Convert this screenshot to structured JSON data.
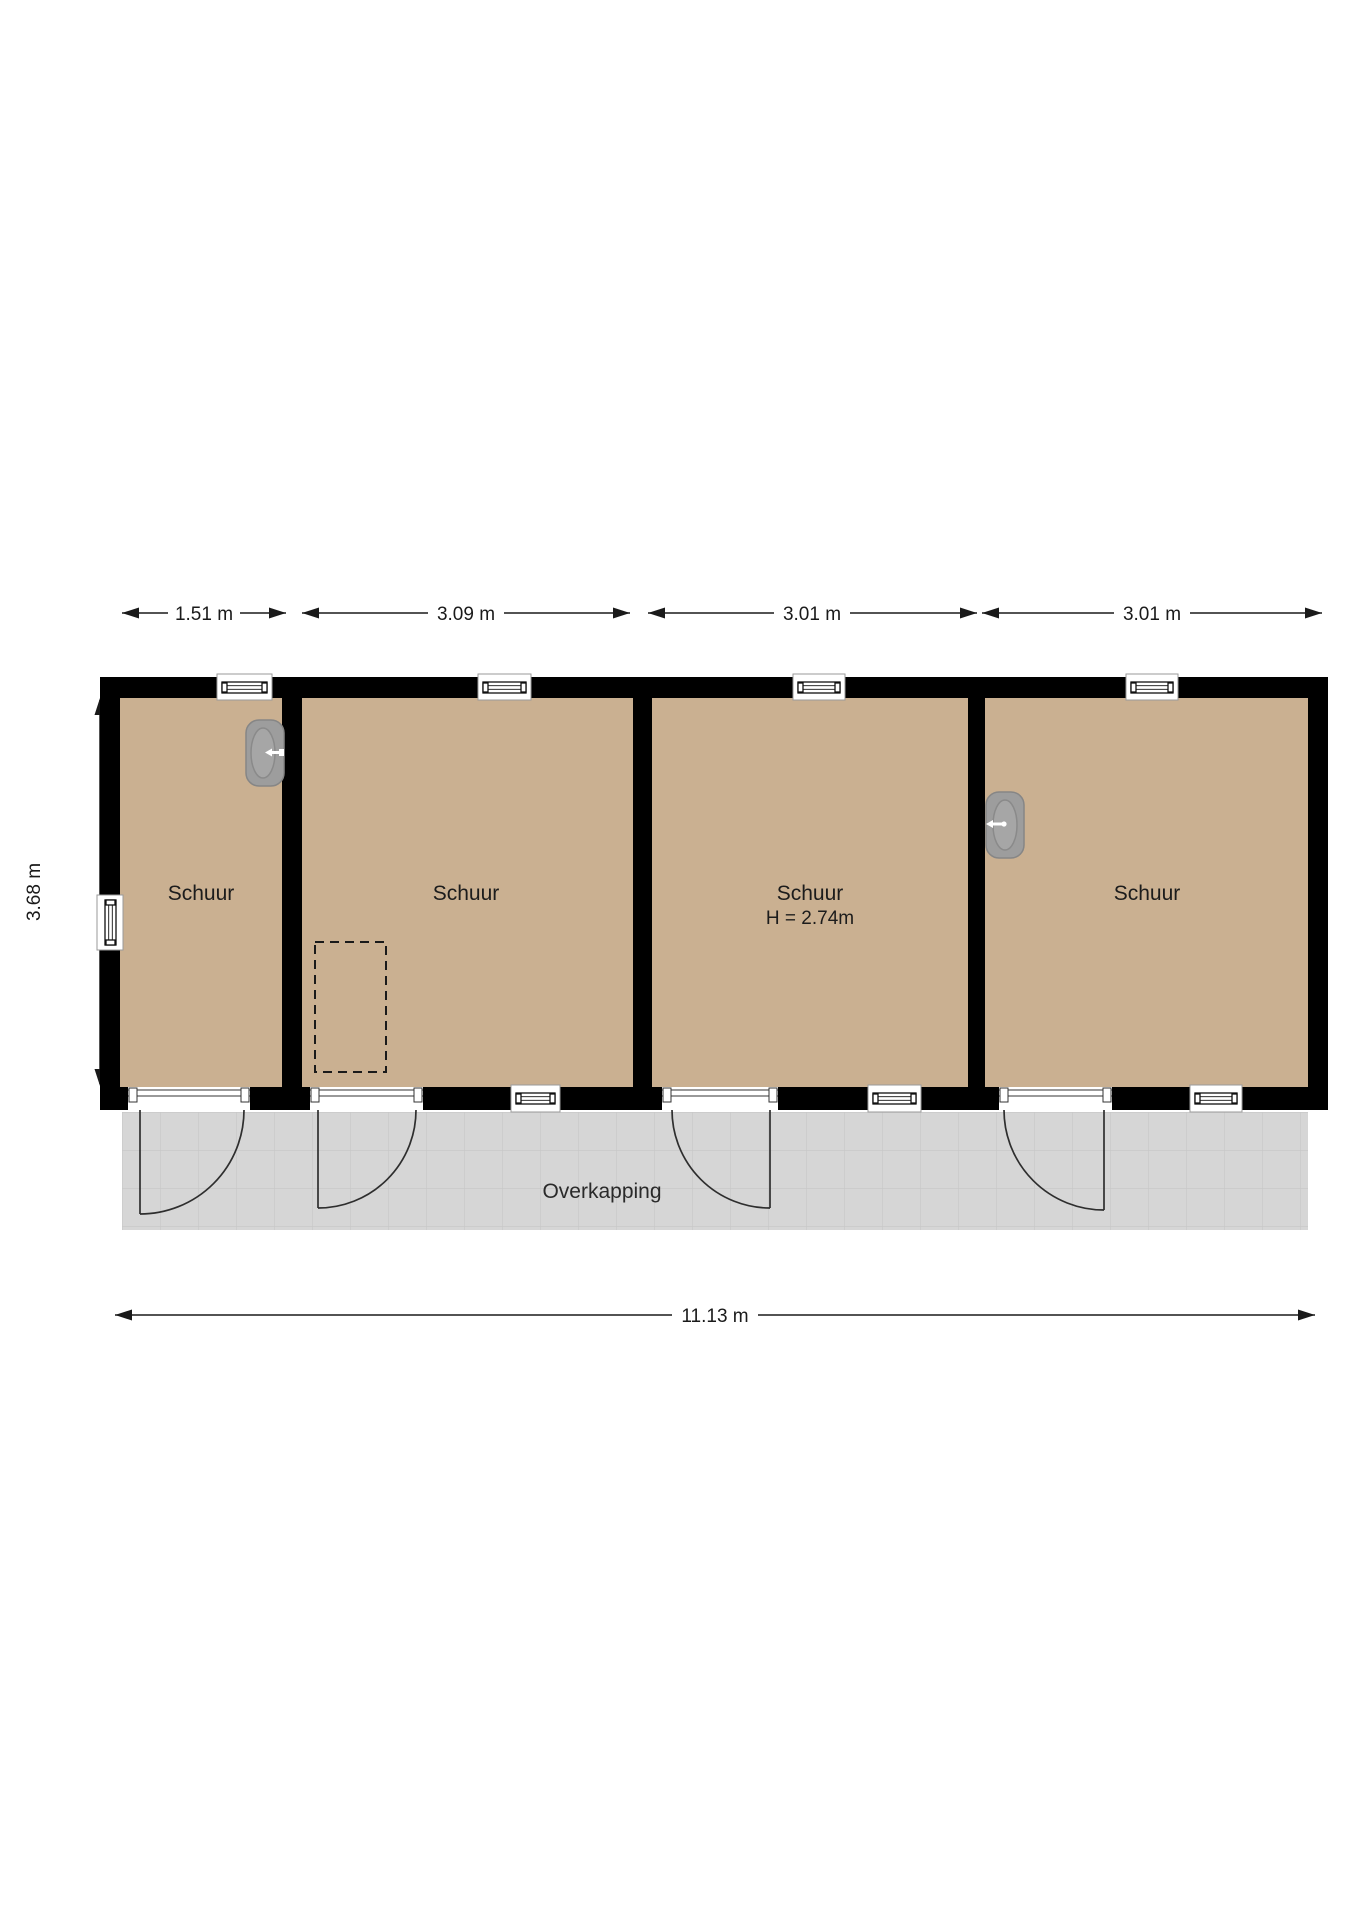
{
  "floorplan": {
    "rooms": [
      {
        "label": "Schuur"
      },
      {
        "label": "Schuur"
      },
      {
        "label": "Schuur",
        "height_label": "H = 2.74m"
      },
      {
        "label": "Schuur"
      }
    ],
    "canopy": {
      "label": "Overkapping"
    },
    "dimensions": {
      "top": [
        {
          "label": "1.51 m"
        },
        {
          "label": "3.09 m"
        },
        {
          "label": "3.01 m"
        },
        {
          "label": "3.01 m"
        }
      ],
      "left": {
        "label": "3.68 m"
      },
      "bottom": {
        "label": "11.13 m"
      }
    },
    "colors": {
      "wall": "#000000",
      "floor": "#cab091",
      "canopy": "#d6d6d6",
      "canopy_grid": "#c7c7c7",
      "sink": "#9d9d9d",
      "sink_basin": "#a6a6a6"
    }
  }
}
